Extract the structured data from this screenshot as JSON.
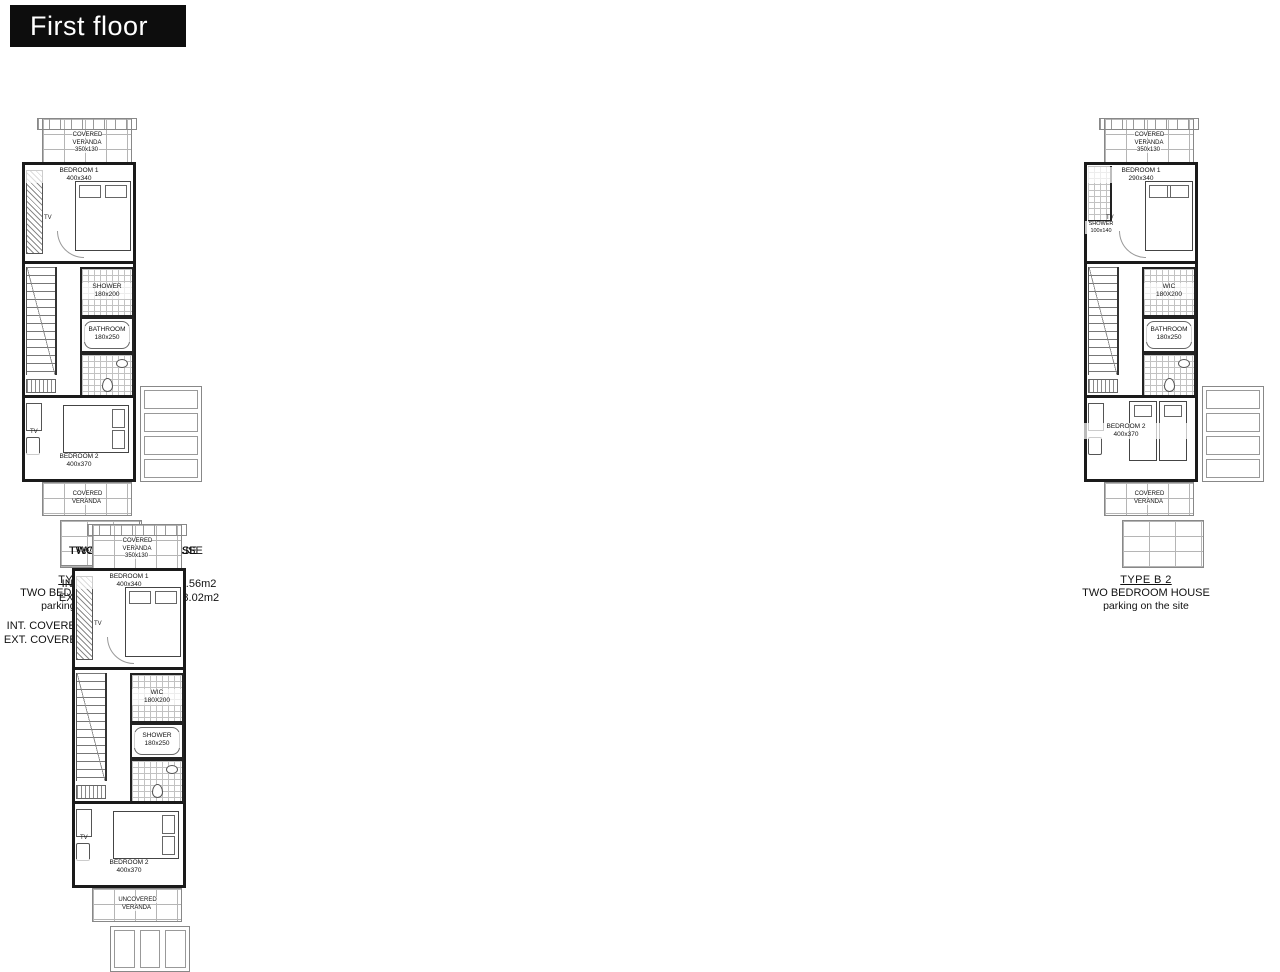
{
  "title": "First floor",
  "plans": [
    {
      "parking": "bottom",
      "veranda_top": "COVERED\nVERANDA\n350x130",
      "bedroom1": {
        "name": "BEDROOM 1",
        "dim": "400x340"
      },
      "tv1": "TV",
      "mid1": {
        "name": "SHOWER",
        "dim": "180x200"
      },
      "mid2": {
        "name": "BATHROOM",
        "dim": "180x250"
      },
      "tv2": "TV",
      "bedroom2": {
        "name": "BEDROOM 2",
        "dim": "400x370"
      },
      "veranda_bottom": "COVERED\nVERANDA",
      "caption": {
        "type": "TYPE A 1",
        "line1": "TWO BEDROOM HOUSE",
        "line2": "parking infront",
        "area1": "INT. COVERED AREA 54.56m2",
        "area2": "EXT. COVERED AREAS 8.02m2"
      }
    },
    {
      "parking": "right",
      "veranda_top": "COVERED\nVERANDA\n350x130",
      "bedroom1": {
        "name": "BEDROOM 1",
        "dim": "400x340"
      },
      "tv1": "TV",
      "mid1": {
        "name": "SHOWER",
        "dim": "180x200"
      },
      "mid2": {
        "name": "BATHROOM",
        "dim": "180x250"
      },
      "tv2": "TV",
      "bedroom2": {
        "name": "BEDROOM 2",
        "dim": "400x370"
      },
      "veranda_bottom": "COVERED\nVERANDA",
      "caption": {
        "type": "TYPE B 1",
        "line1": "TWO BEDROOM HOUSE",
        "line2": "parking on the site",
        "area1": "INT. COVERED AREA 54.56m2",
        "area2": "EXT. COVERED AREAS 8.67m2"
      }
    },
    {
      "parking": "bottom",
      "veranda_top": "COVERED\nVERANDA\n350x130",
      "bedroom1": {
        "name": "BEDROOM 1",
        "dim": "400x340"
      },
      "tv1": "TV",
      "mid1": {
        "name": "WIC",
        "dim": "180X230"
      },
      "mid2": {
        "name": "BATHROOM",
        "dim": "180x220"
      },
      "tv2": "TV",
      "bedroom2": {
        "name": "BEDROOM 2",
        "dim": "400x370"
      },
      "veranda_bottom": "UNCOVERED\nVERANDA",
      "caption": {
        "type": "TYPE A 2",
        "line1": "TWO BEDROOM HOUSE",
        "line2": "parking infront"
      }
    },
    {
      "parking": "bottom",
      "veranda_top": "COVERED\nVERANDA\n350x130",
      "bedroom1": {
        "name": "BEDROOM 1",
        "dim": "400x340"
      },
      "tv1": "TV",
      "mid1": {
        "name": "LAUNDRY",
        "dim": "180X200"
      },
      "mid2": {
        "name": "BATHROOM",
        "dim": "180x250"
      },
      "tv2": "TV",
      "bedroom2": {
        "name": "BEDROOM 2",
        "dim": "400x370"
      },
      "veranda_bottom": "UNCOVERED\nVERANDA",
      "caption": {
        "type": "TYPE A 3",
        "line1": "TWO BEDROOM HOUSE",
        "line2": "parking infront"
      }
    },
    {
      "parking": "bottom",
      "veranda_top": "COVERED\nVERANDA\n350x130",
      "bedroom1": {
        "name": "BEDROOM 1",
        "dim": "400x340"
      },
      "tv1": "TV",
      "mid1": {
        "name": "WIC",
        "dim": "180X200"
      },
      "mid2": {
        "name": "SHOWER",
        "dim": "180x250"
      },
      "tv2": "TV",
      "bedroom2": {
        "name": "BEDROOM 2",
        "dim": "400x370"
      },
      "veranda_bottom": "UNCOVERED\nVERANDA",
      "caption": {
        "type": "TYPE A 4",
        "line1": "TWO BEDROOM HOUSE",
        "line2": "parking infront"
      }
    },
    {
      "parking": "right",
      "variant": "b2",
      "veranda_top": "COVERED\nVERANDA\n350x130",
      "bedroom1": {
        "name": "BEDROOM 1",
        "dim": "290x340"
      },
      "tv1": "TV",
      "top_shower": "SHOWER\n100x140",
      "mid1": {
        "name": "WIC",
        "dim": "180X200"
      },
      "mid2": {
        "name": "BATHROOM",
        "dim": "180x250"
      },
      "bedroom2": {
        "name": "BEDROOM 2",
        "dim": "400x370"
      },
      "veranda_bottom": "COVERED\nVERANDA",
      "caption": {
        "type": "TYPE B 2",
        "line1": "TWO BEDROOM HOUSE",
        "line2": "parking on the site"
      }
    }
  ]
}
